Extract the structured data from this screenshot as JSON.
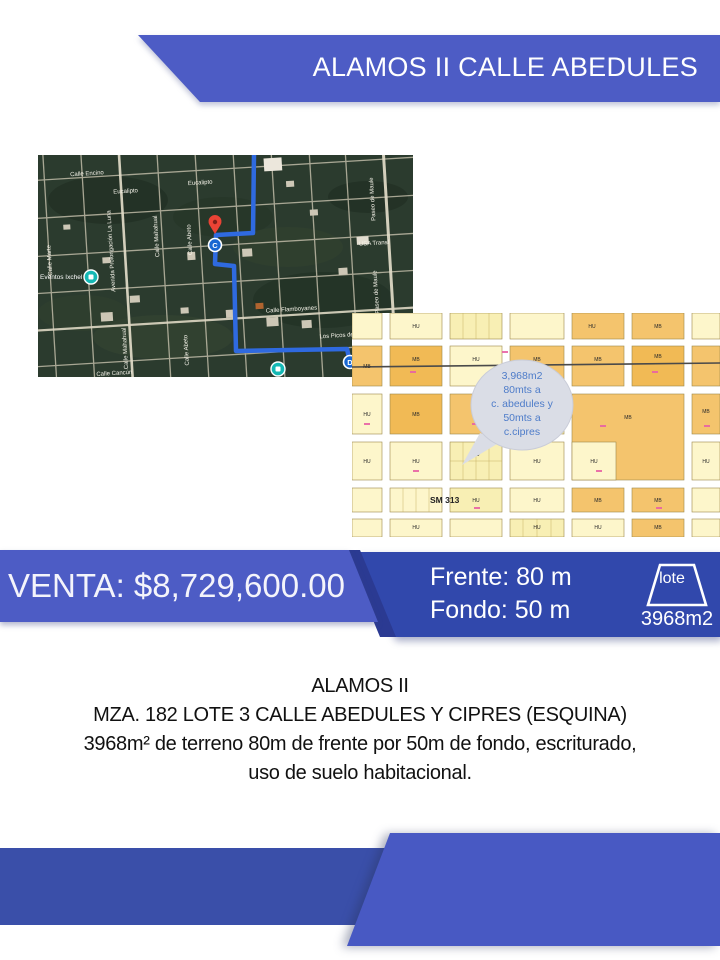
{
  "header": {
    "title": "ALAMOS II CALLE ABEDULES"
  },
  "satellite_map": {
    "street_labels": {
      "calle_encino": "Calle Encino",
      "eucalipto_1": "Eucalipto",
      "eucalipto_2": "Eucalipto",
      "calle_marte": "Calle Marte",
      "av_prolongacion_la_luna": "Avenida Prolongación La Luna",
      "calle_mahahual_1": "Calle Mahahual",
      "calle_abeto_1": "Calle Abeto",
      "calle_mahahual_2": "Calle Mahahual",
      "calle_abeto_2": "Calle Abeto",
      "usa_transf": "USA Transf",
      "calle_flamboyanes": "Calle Flamboyanes",
      "paseo_de_maule_1": "Paseo de Maule",
      "paseo_de_maule_2": "Paseo de Maule",
      "los_picos": "Los Picos de Ev",
      "calle_cancun": "Calle Cancún",
      "eventos_ixchel": "Eventos Ixchel"
    },
    "markers": {
      "c": "C",
      "d": "D"
    }
  },
  "cadastral_map": {
    "bubble": {
      "line1": "3,968m2",
      "line2": "80mts a",
      "line3": "c. abedules y",
      "line4": "50mts  a",
      "line5": "c.cipres"
    },
    "sector_label": "SM 313",
    "block_label_mb": "MB",
    "block_label_hu": "HU"
  },
  "price_banner": {
    "text": "VENTA: $8,729,600.00"
  },
  "dimensions_banner": {
    "frente": "Frente: 80 m",
    "fondo": "Fondo: 50 m"
  },
  "lote_badge": {
    "label": "lote",
    "area": "3968m2"
  },
  "description": {
    "line1": "ALAMOS II",
    "line2": "MZA. 182 LOTE 3 CALLE ABEDULES Y CIPRES (ESQUINA)",
    "line3": "3968m² de terreno 80m de frente por 50m de fondo, escriturado,",
    "line4": "uso de suelo habitacional."
  },
  "colors": {
    "banner_blue": "#4d5cc5",
    "banner_dark_blue": "#3148ac",
    "accent_navy": "#2b3a92",
    "footer_left": "#3a4fa9",
    "footer_right": "#4859c3"
  }
}
